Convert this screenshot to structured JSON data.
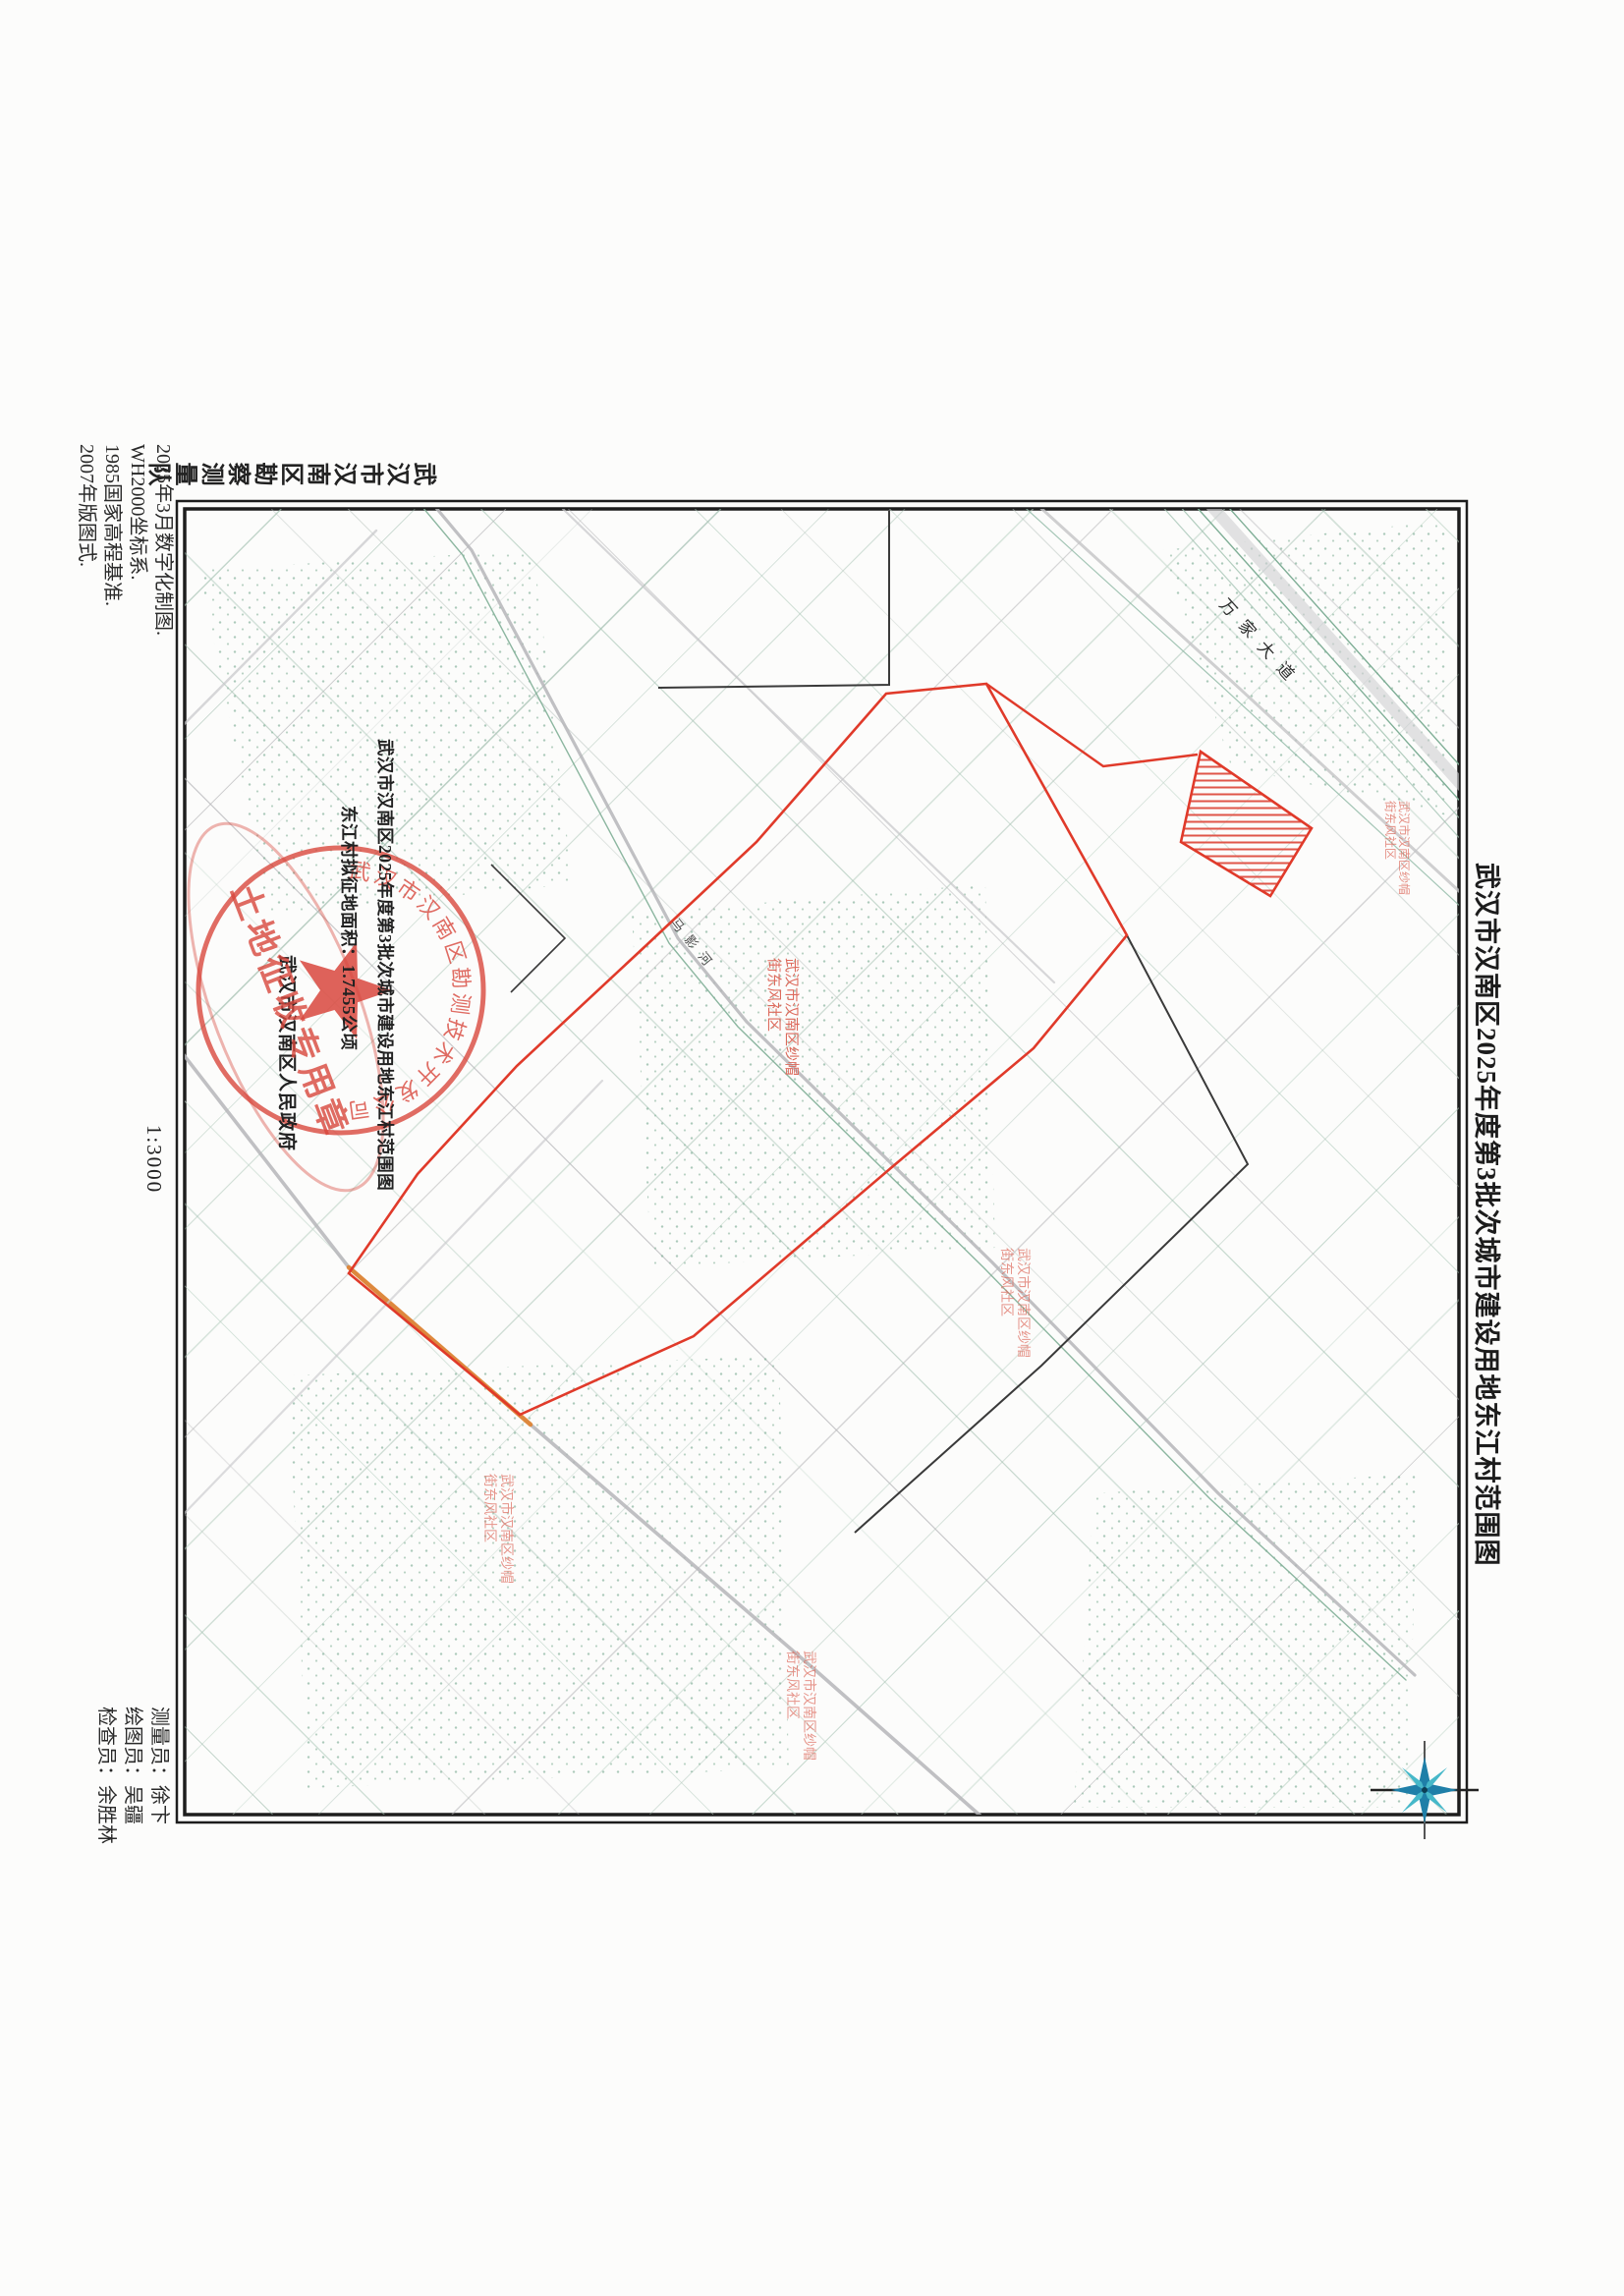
{
  "page": {
    "title": "武汉市汉南区2025年度第3批次城市建设用地东江村范围图",
    "agency": "武汉市汉南区勘察测量队",
    "scale": "1:3000",
    "annotation": {
      "line1": "武汉市汉南区2025年度第3批次城市建设用地东江村范围图",
      "line2": "东江村拟征地面积：1.7455公顷",
      "signer": "武汉市汉南区人民政府"
    },
    "stamp": {
      "arc": "武汉市汉南区勘测技术开发公司",
      "banner": "土地征收专用章"
    },
    "notes": [
      "2025年3月数字化制图.",
      "WH2000坐标系.",
      "1985国家高程基准.",
      "2007年版图式."
    ],
    "credits": [
      {
        "text": "测量员：徐卞"
      },
      {
        "text": "绘图员：吴疆"
      },
      {
        "text": "检查员：余胜林"
      }
    ],
    "map_labels": {
      "road": "万家大道",
      "river": "马影河",
      "zone_line1": "武汉市汉南区纱帽",
      "zone_line2": "街东风社区"
    }
  }
}
